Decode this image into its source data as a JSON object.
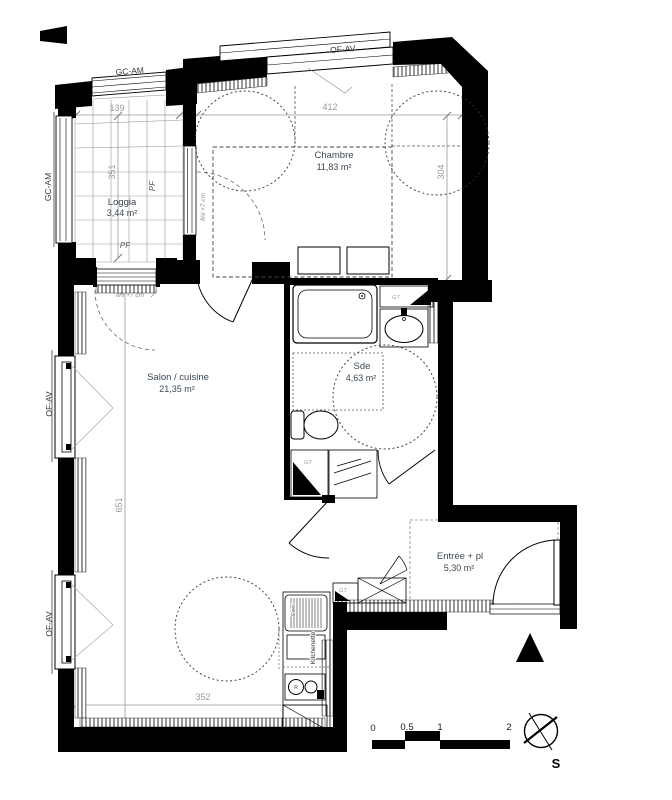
{
  "plan": {
    "type": "apartment-floor-plan"
  },
  "rooms": [
    {
      "id": "loggia",
      "name": "Loggia",
      "area": "3,44 m²"
    },
    {
      "id": "chambre",
      "name": "Chambre",
      "area": "11,83 m²"
    },
    {
      "id": "salon",
      "name": "Salon / cuisine",
      "area": "21,35 m²"
    },
    {
      "id": "sde",
      "name": "Sde",
      "area": "4,63 m²"
    },
    {
      "id": "entree",
      "name": "Entrée + pl",
      "area": "5,30 m²"
    }
  ],
  "windows": {
    "gc_am": "GC-AM",
    "of_av": "OF-AV",
    "pf": "PF"
  },
  "annotations": {
    "fini": "fini +7 cm",
    "gt": "GT",
    "evier": "Evier",
    "kitchenette": "Kitchenette",
    "hob": "R"
  },
  "dimensions": {
    "loggia_w": "139",
    "loggia_h": "351",
    "chambre_w": "412",
    "chambre_h": "304",
    "salon_h": "651",
    "salon_w": "352"
  },
  "scale_bar": {
    "ticks": [
      "0",
      "0.5",
      "1",
      "2"
    ]
  },
  "compass": {
    "south": "S"
  },
  "colors": {
    "wall": "#000000",
    "room_text": "#3a4754",
    "dim_text": "#9a9a9a",
    "label_text": "#3c3c3c",
    "background": "#ffffff"
  }
}
